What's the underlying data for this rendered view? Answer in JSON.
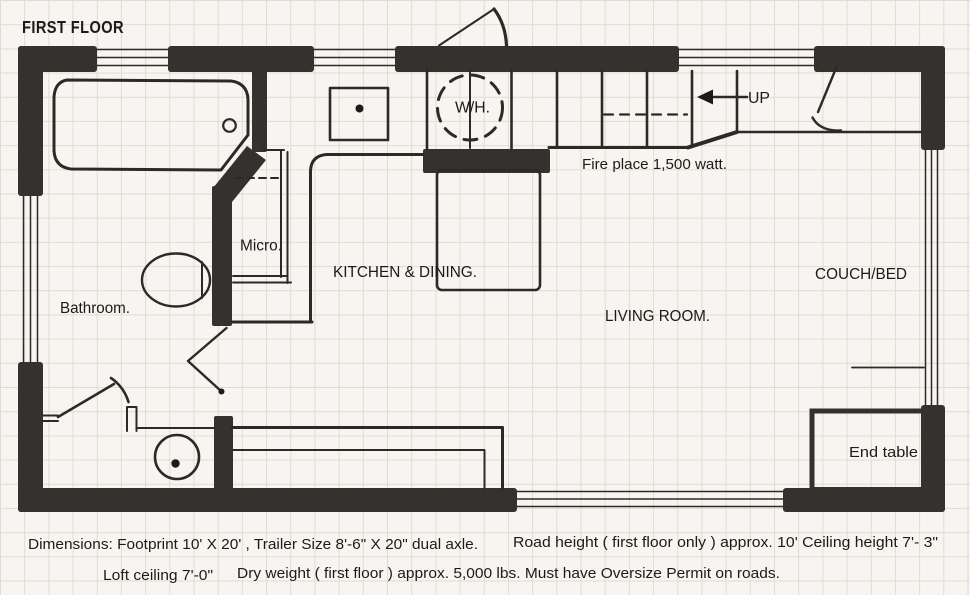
{
  "title": "FIRST FLOOR",
  "labels": {
    "bathroom": "Bathroom.",
    "kitchen_dining": "KITCHEN & DINING.",
    "living_room": "LIVING ROOM.",
    "couch_bed": "COUCH/BED",
    "micro": "Micro.",
    "water_heater": "W/H.",
    "up": "UP",
    "fireplace": "Fire place 1,500 watt.",
    "end_table": "End table"
  },
  "notes": {
    "dimensions": "Dimensions: Footprint 10' X 20' , Trailer Size 8'-6\" X 20\" dual axle.",
    "road_height": "Road height ( first floor only ) approx. 10'  Ceiling height 7'- 3\"",
    "loft_ceiling": "Loft ceiling 7'-0\"",
    "dry_weight": "Dry weight ( first floor ) approx. 5,000 lbs.  Must have Oversize Permit on roads."
  },
  "colors": {
    "wall": "#34322e",
    "line": "#2b2a27",
    "ink": "#1c1b19",
    "paper": "#f7f5f1",
    "grid": "#e2dccd"
  }
}
